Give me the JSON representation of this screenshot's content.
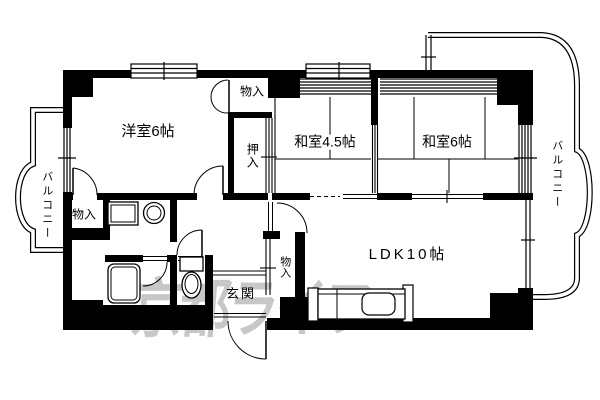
{
  "floorplan": {
    "labels": {
      "western_room": "洋室6帖",
      "japanese_room_45": "和室4.5帖",
      "japanese_room_6": "和室6帖",
      "ldk": "LDK10帖",
      "entrance": "玄関",
      "oshiire_closet": "押入",
      "storage_top": "物入",
      "storage_bottom_left": "物入",
      "storage_entrance": "物入",
      "balcony_left": "バルコニー",
      "balcony_right": "バルコニー"
    },
    "watermark": "京都ライフ",
    "colors": {
      "line": "#000000",
      "background": "#ffffff",
      "watermark": "#9b9b9b"
    }
  }
}
